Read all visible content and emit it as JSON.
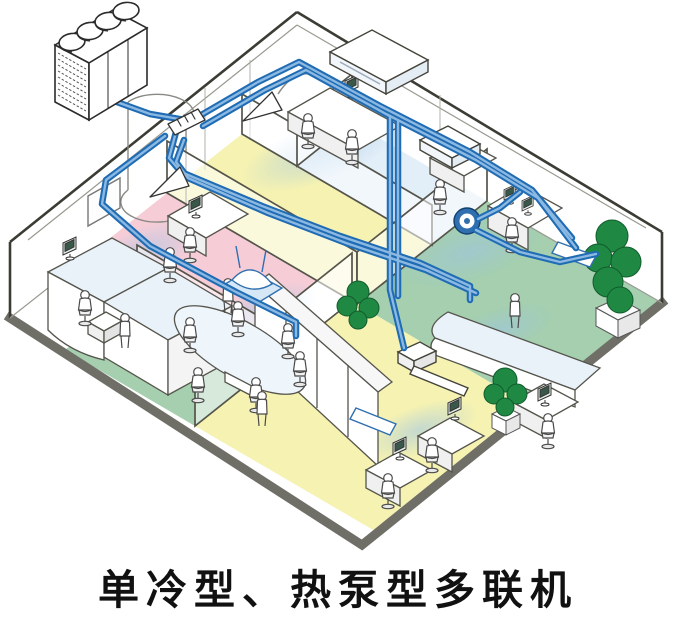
{
  "caption": {
    "text": "单冷型、热泵型多联机"
  },
  "colors": {
    "floor_pink": "#f6cdd7",
    "floor_yellow": "#f5f2b2",
    "floor_green": "#a5cfae",
    "floor_blue": "#e2eef8",
    "pipe_dark": "#1f6cb4",
    "pipe_light": "#8cb9e2",
    "plant_green": "#1f8843",
    "plant_dark": "#125c2c",
    "baseboard_gray": "#6f6f68",
    "outline": "#3c3c35",
    "unit_blue": "#2f6fb0",
    "cassette_blue": "#d6e7f5",
    "air_blue": "#a9cbe9",
    "caption_color": "#111111"
  },
  "components": [
    "vrf-outdoor-unit",
    "refrigerant-pipe-network",
    "branch-joint",
    "distribution-header",
    "ceiling-suspended-indoor-unit",
    "four-way-cassette-indoor-unit",
    "round-flow-cassette-indoor-unit",
    "slim-duct-indoor-unit",
    "office-building-cutaway",
    "meeting-table",
    "reception-counter",
    "office-workers",
    "potted-plants"
  ]
}
